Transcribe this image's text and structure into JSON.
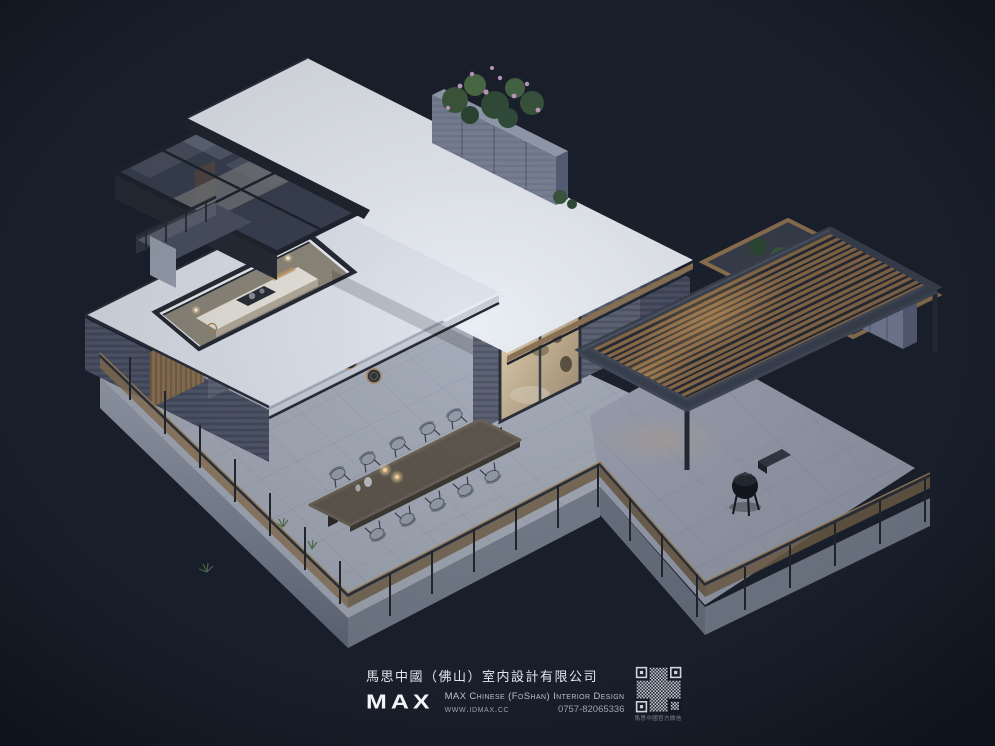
{
  "scene": {
    "alt": "Aerial dusk 3D rendering of a modern single-storey flat-roof house with a glass-roofed wing, kitchen skylight, outdoor dining terrace with long wooden table, slatted timber pergola, rooftop planters and a kettle barbecue grill"
  },
  "palette": {
    "bg": "#1b212e",
    "roof": "#e9edf4",
    "roof_dim": "#dfe4ee",
    "glass": "#323948",
    "brick": "#5a6173",
    "brick_light": "#6e7688",
    "stone": "#7b8498",
    "concrete": "#99a0af",
    "floor": "#b3b9c7",
    "floor_dim": "#9ba1b1",
    "wood": "#8d7355",
    "slat": "#8a6b49",
    "frame": "#3b4250",
    "warm": "#e8b26a",
    "glow": "#ffd9a0",
    "table": "#5f584e",
    "chair": "#98a0ad",
    "green": "#3f5a3d",
    "green_dark": "#2f4a36",
    "flower": "#c9a3cb",
    "text": "#e3e6ee",
    "text_dim": "#b9bfcc",
    "text_muted": "#9aa0ae"
  },
  "footer": {
    "company_cn": "馬思中國（佛山）室内設計有限公司",
    "logo": "MAX",
    "company_en": "MAX Chinese (FoShan) Interior Design",
    "website": "www.idmax.cc",
    "phone": "0757-82065336",
    "qr_caption": "馬思中國官方微信"
  }
}
